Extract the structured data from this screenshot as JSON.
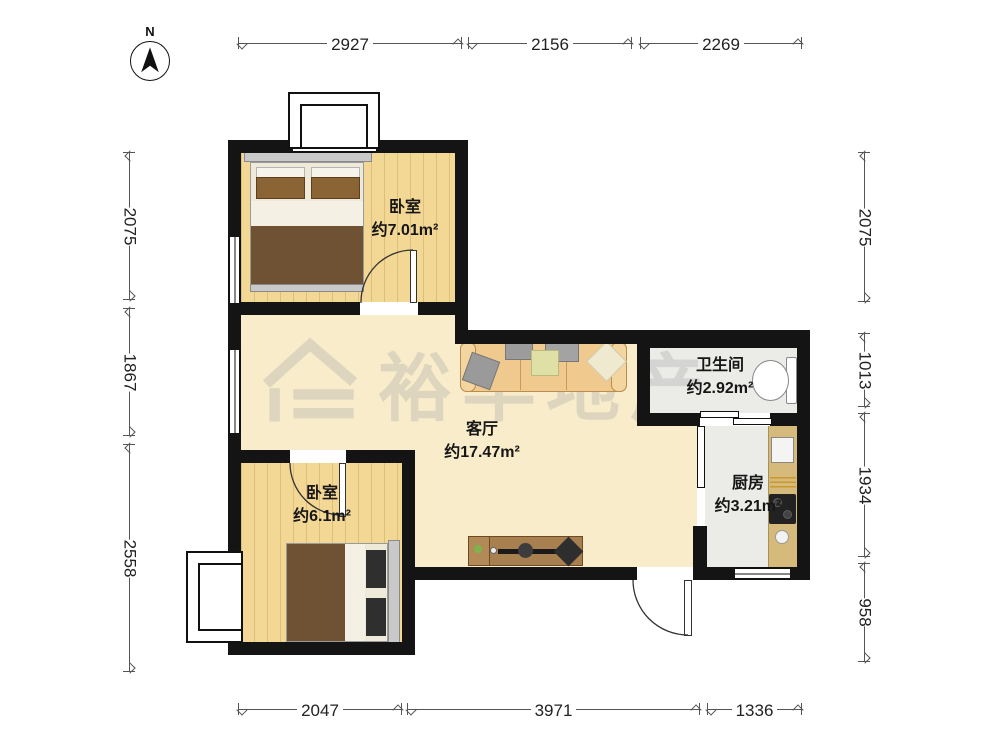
{
  "north": {
    "label": "N"
  },
  "watermark": {
    "text": "裕丰地产",
    "logo_icon": "house-logo-icon"
  },
  "rooms": {
    "bedroom_top": {
      "name": "卧室",
      "area": "约7.01m²"
    },
    "living_room": {
      "name": "客厅",
      "area": "约17.47m²"
    },
    "bathroom": {
      "name": "卫生间",
      "area": "约2.92m²"
    },
    "kitchen": {
      "name": "厨房",
      "area": "约3.21m²"
    },
    "bedroom_bottom": {
      "name": "卧室",
      "area": "约6.1m²"
    }
  },
  "dimensions_mm": {
    "top": [
      "2927",
      "2156",
      "2269"
    ],
    "left": [
      "2075",
      "1867",
      "2558"
    ],
    "right": [
      "2075",
      "1013",
      "1934",
      "958"
    ],
    "bottom": [
      "2047",
      "3971",
      "1336"
    ]
  },
  "colors": {
    "wall": "#141414",
    "wood_floor": "#f3d795",
    "marble_floor": "#f8ecca",
    "tile_floor": "#ebebe7",
    "counter": "#d6ba7c",
    "blanket": "#6f5233",
    "sofa": "#f0c98e"
  }
}
